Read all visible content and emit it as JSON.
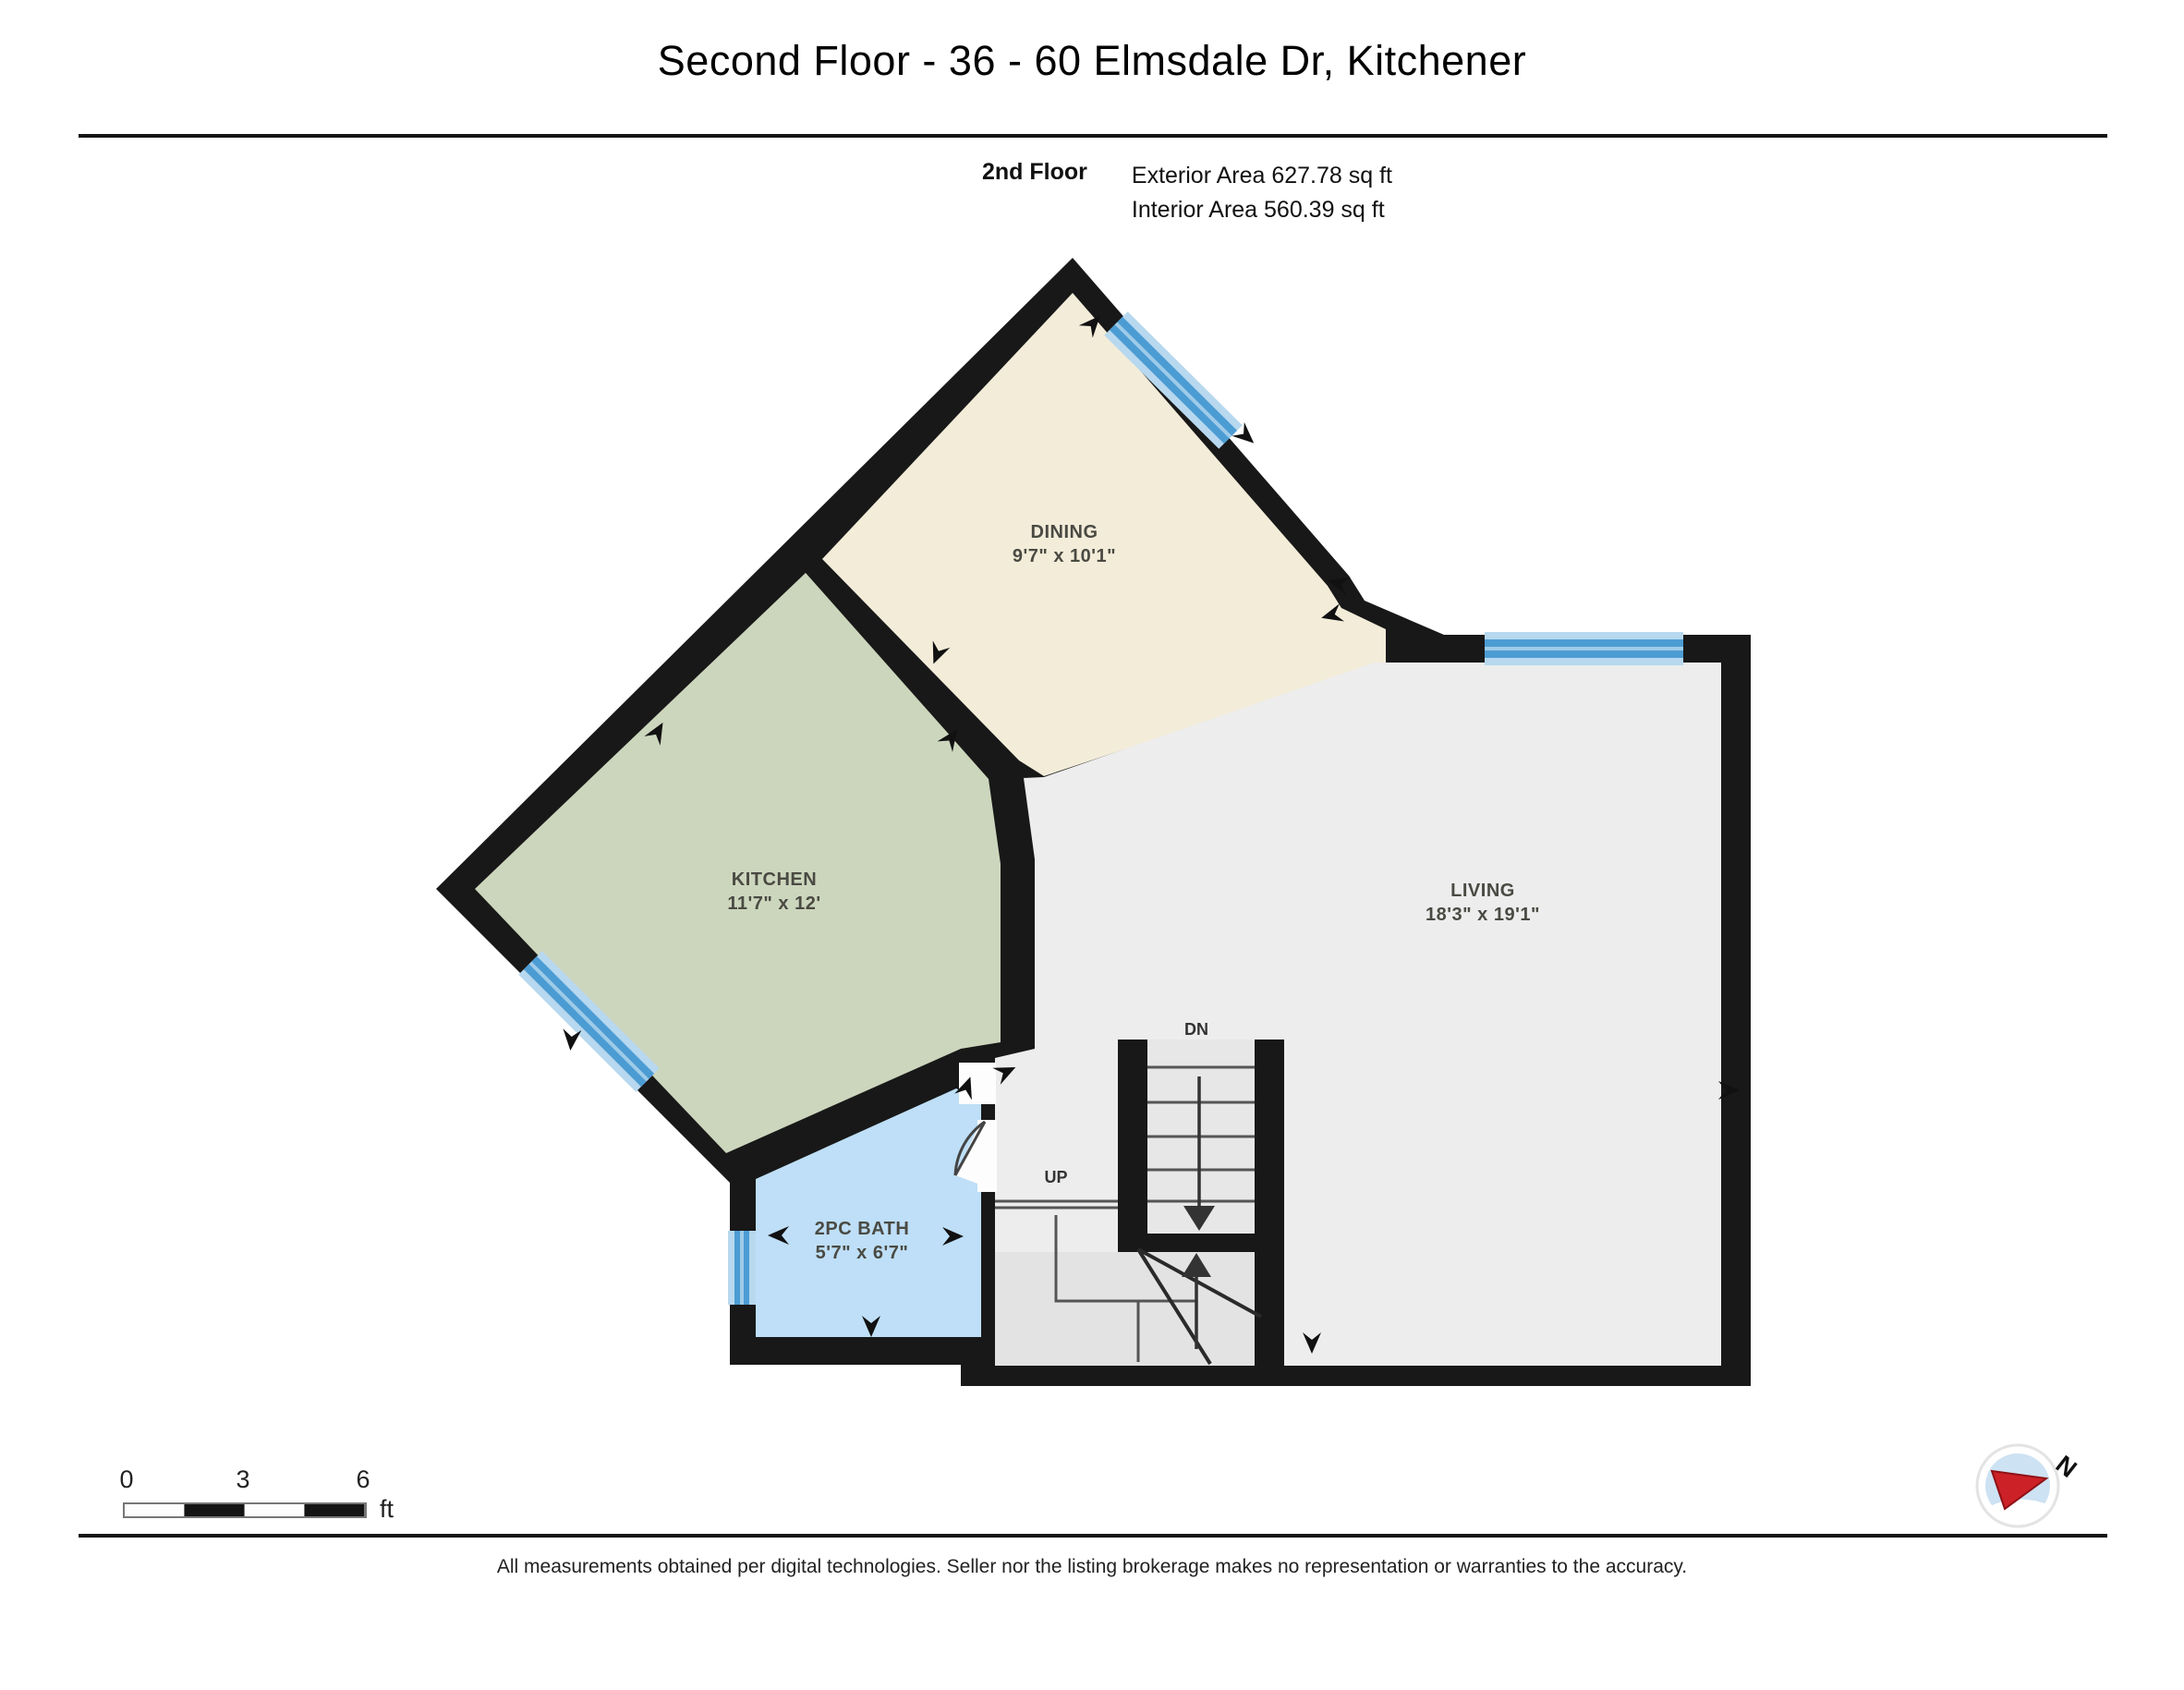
{
  "title": "Second Floor - 36 - 60 Elmsdale Dr, Kitchener",
  "floor_info": {
    "floor_name": "2nd Floor",
    "exterior_area": "Exterior Area 627.78 sq ft",
    "interior_area": "Interior Area 560.39 sq ft"
  },
  "rooms": [
    {
      "name": "DINING",
      "dims": "9'7\" x 10'1\""
    },
    {
      "name": "KITCHEN",
      "dims": "11'7\" x 12'"
    },
    {
      "name": "LIVING",
      "dims": "18'3\" x 19'1\""
    },
    {
      "name": "2PC BATH",
      "dims": "5'7\" x 6'7\""
    }
  ],
  "stairs": {
    "down_label": "DN",
    "up_label": "UP"
  },
  "scale_bar": {
    "tick0": "0",
    "tick3": "3",
    "tick6": "6",
    "unit": "ft"
  },
  "compass": {
    "north_label": "N"
  },
  "footer": "All measurements obtained per digital technologies. Seller nor the listing brokerage makes no representation or warranties to the accuracy.",
  "colors": {
    "wall": "#181818",
    "dining_floor": "#f2ecd9",
    "kitchen_floor": "#ccd6bd",
    "living_floor": "#ededee",
    "bath_floor": "#bedff7",
    "stair_floor": "#e7e7e8",
    "window_light": "#b7d8ee",
    "window_dark": "#4c9cd4",
    "compass_needle": "#cc2127"
  }
}
